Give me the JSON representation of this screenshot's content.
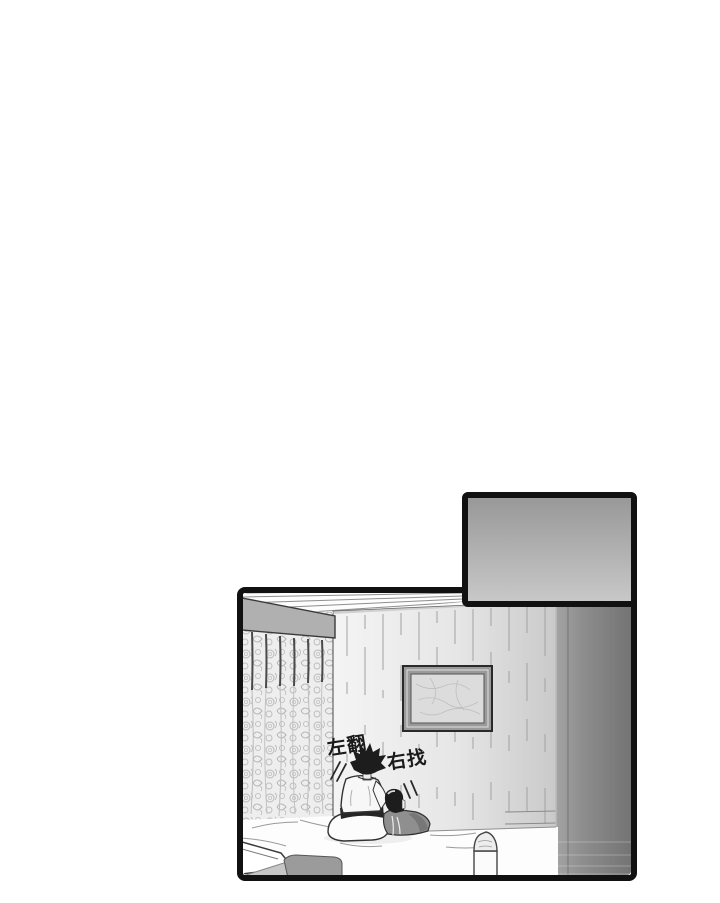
{
  "sfx": {
    "left": "左翻",
    "right": "右找"
  },
  "colors": {
    "page_background": "#ffffff",
    "panel_border": "#111111",
    "inset_gradient_top": "#979797",
    "inset_gradient_bottom": "#c9c9c9",
    "wall_light": "#f4f4f4",
    "wall_shaded": "#c9c9c9",
    "side_wall_light": "#a3a3a3",
    "side_wall_dark": "#727272",
    "valance_gray": "#b0b0b0",
    "curtain_base": "#eeeeee",
    "curtain_pattern_gray": "#b9b9b9",
    "hair_black": "#1d1d1d",
    "comfort_cloth_gray": "#8f8f8f",
    "blanket_dark": "#9b9b9b",
    "blanket_light": "#c6c6c6",
    "frame_gray": "#9a9a9a",
    "picture_gray": "#dcdcdc",
    "ink": "#1a1a1a"
  }
}
